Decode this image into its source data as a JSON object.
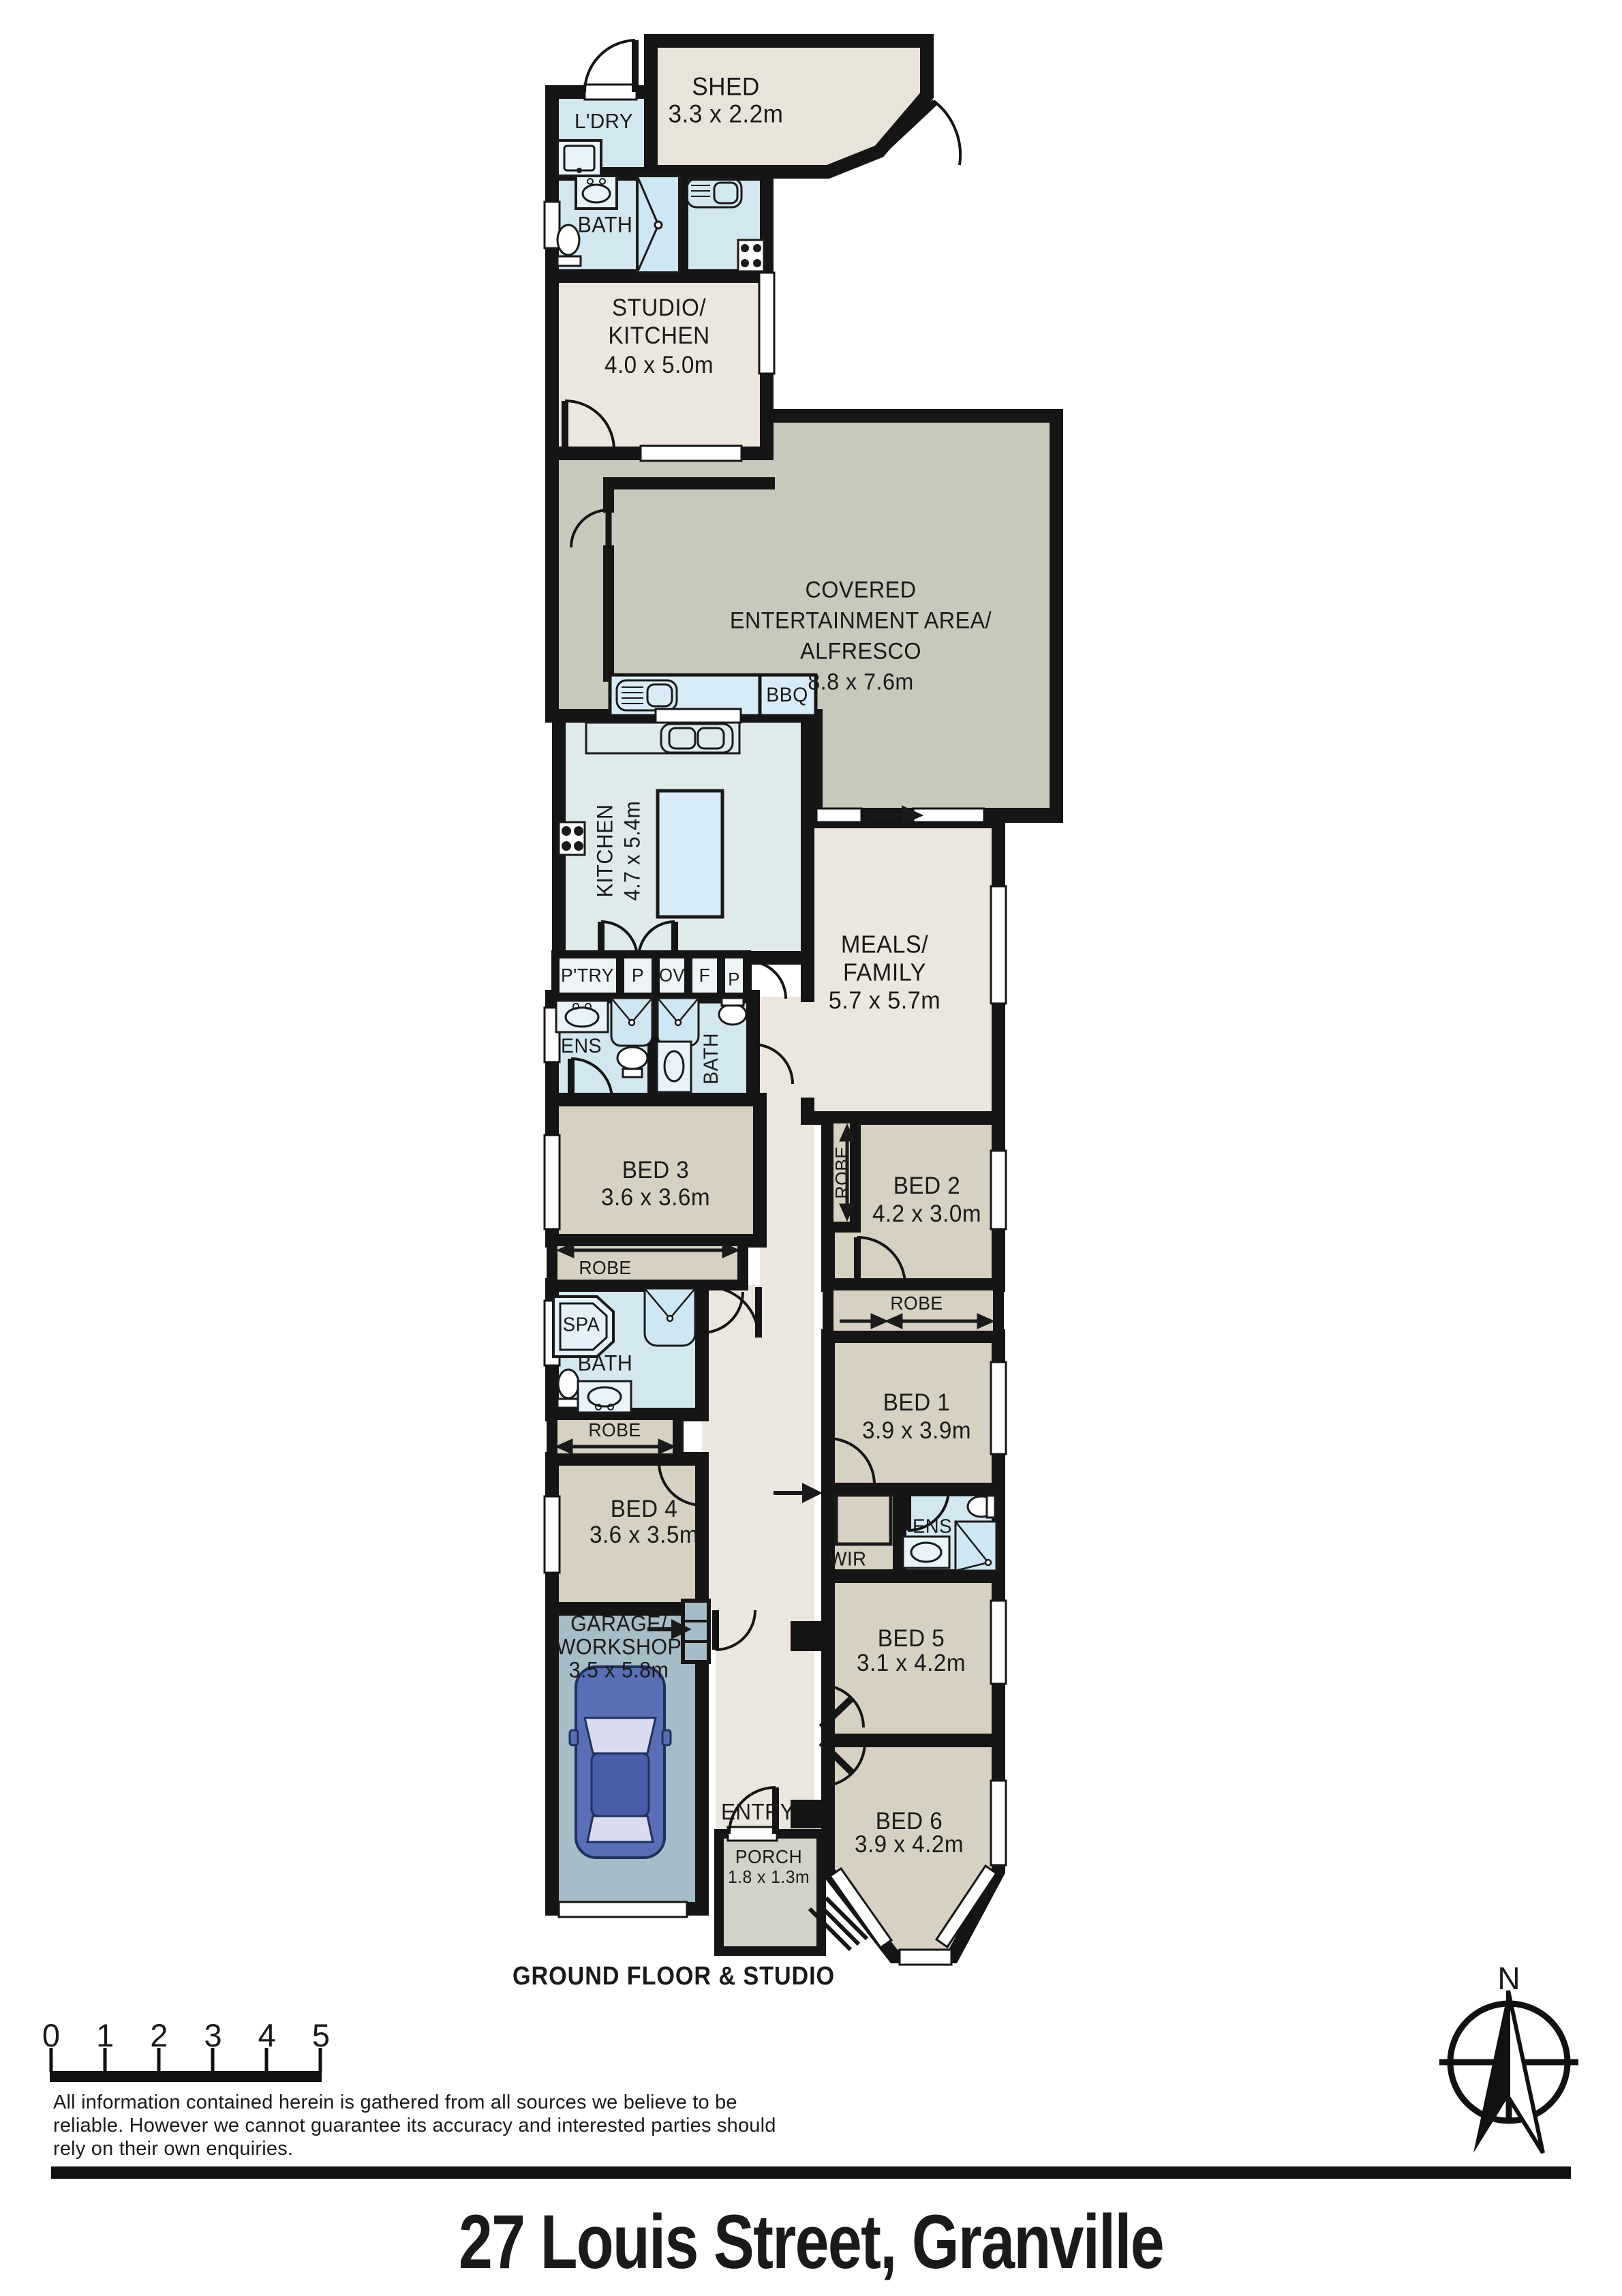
{
  "title": "27 Louis Street, Granville",
  "caption": "GROUND FLOOR & STUDIO",
  "compass": {
    "north": "N"
  },
  "scale_bar": {
    "marks": [
      "0",
      "1",
      "2",
      "3",
      "4",
      "5"
    ]
  },
  "disclaimer": {
    "line1": "All information contained herein is gathered from all sources we believe to be",
    "line2": "reliable. However we cannot guarantee its accuracy and interested parties should",
    "line3": "rely on their own enquiries."
  },
  "rooms": {
    "shed": {
      "label": "SHED",
      "dims": "3.3 x 2.2m"
    },
    "laundry": {
      "label": "L'DRY"
    },
    "studio_bath": {
      "label": "BATH"
    },
    "studio": {
      "line1": "STUDIO/",
      "line2": "KITCHEN",
      "dims": "4.0 x 5.0m"
    },
    "alfresco": {
      "line1": "COVERED",
      "line2": "ENTERTAINMENT AREA/",
      "line3": "ALFRESCO",
      "dims": "8.8 x 7.6m"
    },
    "bbq": {
      "label": "BBQ"
    },
    "kitchen": {
      "label": "KITCHEN",
      "dims": "4.7 x 5.4m"
    },
    "meals": {
      "line1": "MEALS/",
      "line2": "FAMILY",
      "dims": "5.7 x 5.7m"
    },
    "pantry": {
      "label": "P'TRY"
    },
    "p1": {
      "label": "P"
    },
    "oven": {
      "label": "OV"
    },
    "fridge": {
      "label": "F"
    },
    "p2": {
      "label": "P"
    },
    "ens1": {
      "label": "ENS"
    },
    "bath1": {
      "label": "BATH"
    },
    "bed3": {
      "label": "BED 3",
      "dims": "3.6 x 3.6m",
      "robe": "ROBE"
    },
    "bed2": {
      "label": "BED 2",
      "dims": "4.2 x 3.0m",
      "robe": "ROBE"
    },
    "bed1": {
      "label": "BED 1",
      "dims": "3.9 x 3.9m",
      "robe": "ROBE"
    },
    "spa_bath": {
      "spa": "SPA",
      "label": "BATH"
    },
    "bed4": {
      "label": "BED 4",
      "dims": "3.6 x 3.5m",
      "robe": "ROBE"
    },
    "wir": {
      "label": "WIR"
    },
    "ens2": {
      "label": "ENS"
    },
    "bed5": {
      "label": "BED 5",
      "dims": "3.1 x 4.2m"
    },
    "bed6": {
      "label": "BED 6",
      "dims": "3.9 x 4.2m"
    },
    "garage": {
      "line1": "GARAGE/",
      "line2": "WORKSHOP",
      "dims": "3.5 x 5.8m"
    },
    "entry": {
      "label": "ENTRY"
    },
    "porch": {
      "label": "PORCH",
      "dims": "1.8 x 1.3m"
    }
  },
  "colors": {
    "wall": "#151515",
    "bedroom": "#d6d1c0",
    "living": "#ece7de",
    "shed": "#e9e4da",
    "alfresco": "#c9c9bb",
    "porch": "#d2d2c8",
    "wet": "#d2e7f0",
    "kitchen": "#dfeaeb",
    "bench": "#d8ecf8",
    "garage": "#a6bcc6",
    "car": "#5a6eb6"
  }
}
